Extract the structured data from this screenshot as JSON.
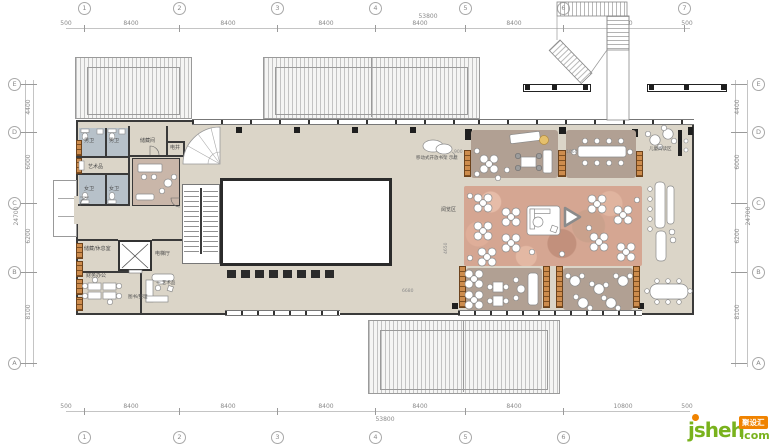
{
  "grid": {
    "c1": "1",
    "c2": "2",
    "c3": "3",
    "c4": "4",
    "c5": "5",
    "c6": "6",
    "c7": "7",
    "rA": "A",
    "rB": "B",
    "rC": "C",
    "rD": "D",
    "rE": "E",
    "d500": "500",
    "d8400": "8400",
    "d10800": "10800",
    "d53800": "53800",
    "d4400": "4400",
    "d6000": "6000",
    "d6200": "6200",
    "d8100": "8100",
    "d24700": "24700"
  },
  "rooms": {
    "wc_m": "男卫",
    "wc_f": "女卫",
    "art": "艺术品",
    "storage": "储藏间",
    "shaft": "电井",
    "storage_rest": "储藏/休息室",
    "elev_hall": "电梯厅",
    "finance": "财务办公",
    "art_note": "一 艺术品",
    "book_sort": "图书/整理",
    "reading": "阅览区",
    "kids": "儿童阅读区"
  },
  "annotations": {
    "cloud": "移动式开放书架 示意",
    "d900": "900",
    "d1060": "1060",
    "d4650": "4650",
    "d6680": "6680"
  },
  "watermark": {
    "word": "jsheh",
    "tld": ".com",
    "badge": "聚设汇"
  }
}
